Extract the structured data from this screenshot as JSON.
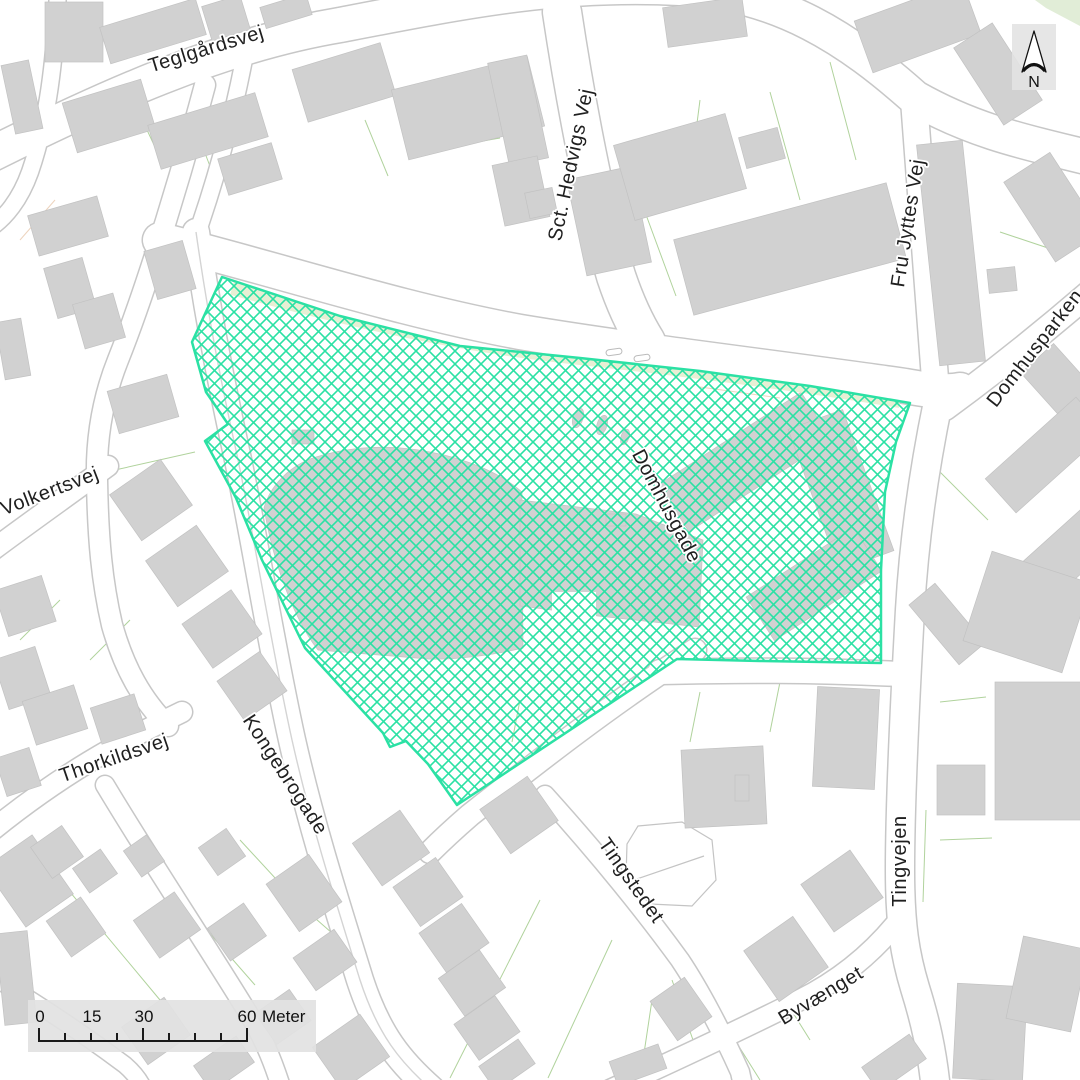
{
  "streets": [
    {
      "name": "teglgaardsvej",
      "text": "Teglgårdsvej"
    },
    {
      "name": "sct-hedvigs-vej",
      "text": "Sct. Hedvigs Vej"
    },
    {
      "name": "fru-jyttes-vej",
      "text": "Fru Jyttes Vej"
    },
    {
      "name": "domhusparken",
      "text": "Domhusparken"
    },
    {
      "name": "domhusgade",
      "text": "Domhusgade"
    },
    {
      "name": "volkertsvej",
      "text": "Volkertsvej"
    },
    {
      "name": "thorkildsvej",
      "text": "Thorkildsvej"
    },
    {
      "name": "kongebrogade",
      "text": "Kongebrogade"
    },
    {
      "name": "tingstedet",
      "text": "Tingstedet"
    },
    {
      "name": "tingvejen",
      "text": "Tingvejen"
    },
    {
      "name": "byvaenget",
      "text": "Byvænget"
    }
  ],
  "north_arrow": {
    "label": "N"
  },
  "scale_bar": {
    "labels": [
      "0",
      "15",
      "30",
      "60"
    ],
    "unit": "Meter"
  },
  "highlight": {
    "description": "hatched-selection-area",
    "color": "#2be1a4"
  },
  "colors": {
    "background": "#ffffff",
    "building": "#d1d1d1",
    "road_casing": "#c7c7c7",
    "road_fill": "#ffffff",
    "parcel_line": "#a8ce92",
    "parcel_line_alt": "#ecd0b8",
    "green_strip": "#e7efd4",
    "panel": "#e3e3e3",
    "highlight": "#2be1a4",
    "label": "#1f1f1f"
  }
}
